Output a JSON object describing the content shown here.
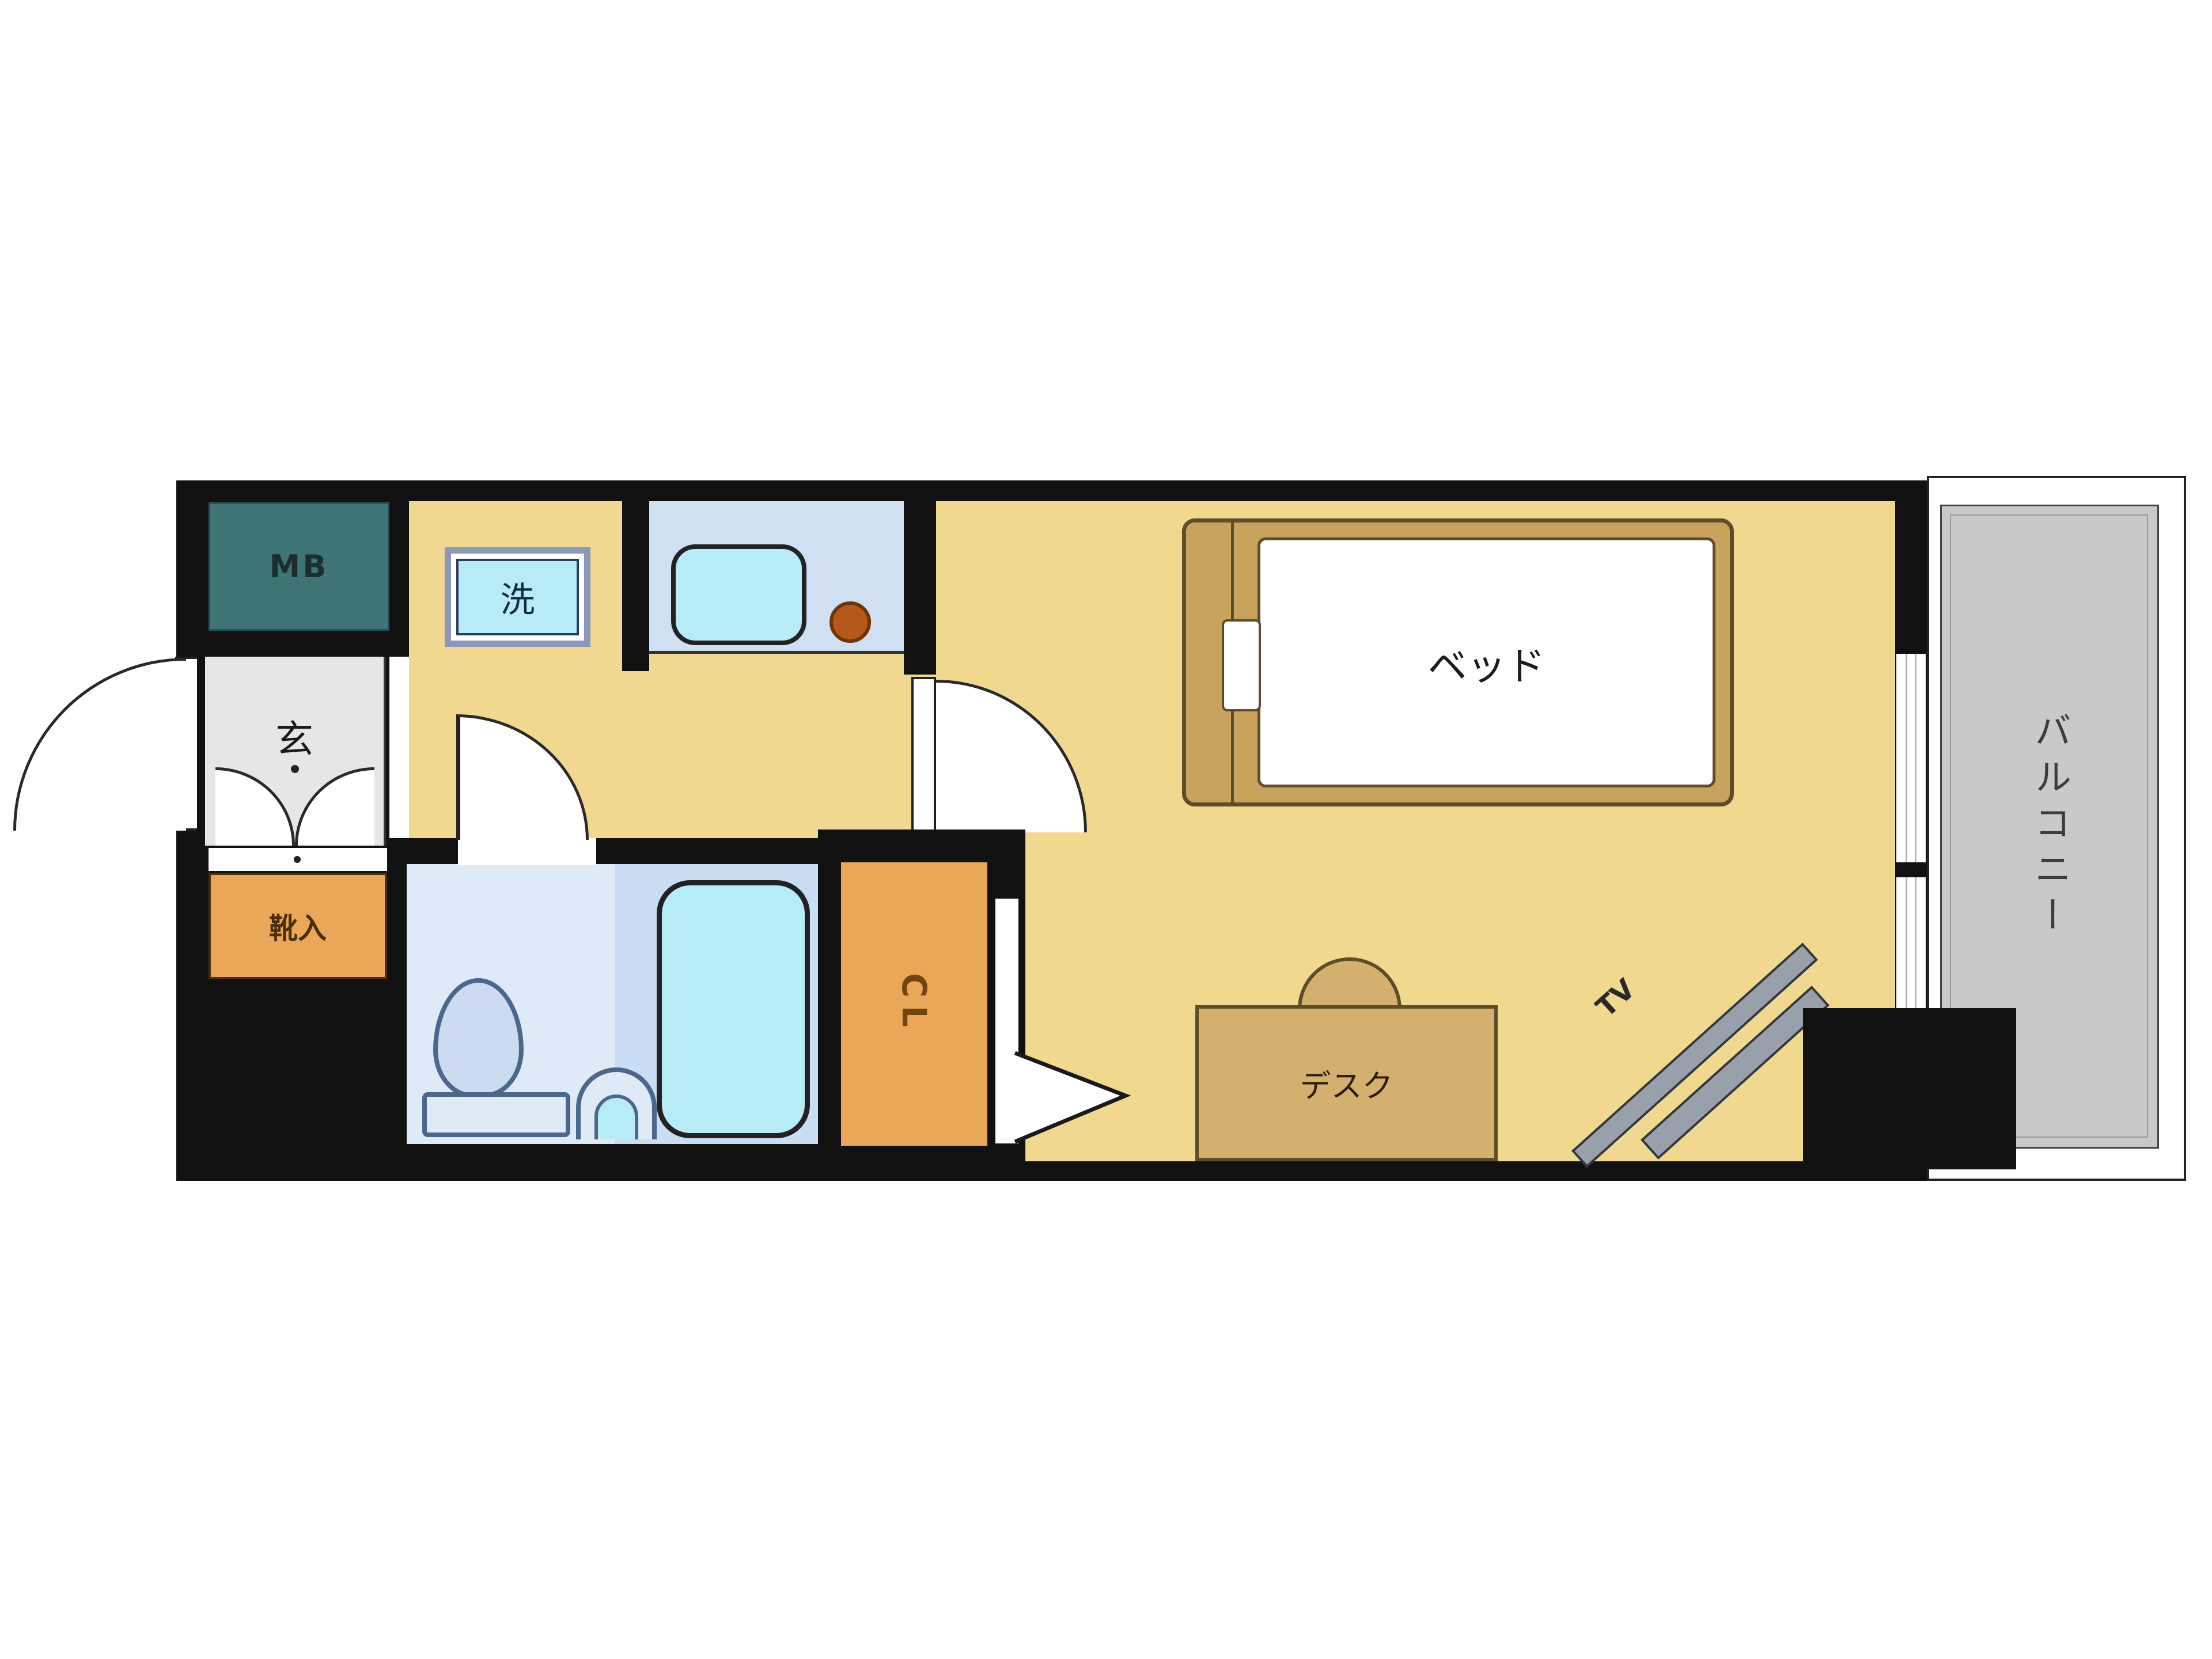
{
  "floorplan": {
    "labels": {
      "meter_box": "MB",
      "entrance": "玄",
      "shoe_cabinet": "靴入",
      "washing_machine": "洗",
      "closet": "CL",
      "bed": "ベッド",
      "desk": "デスク",
      "tv": "TV",
      "balcony": "バルコニー"
    },
    "colors": {
      "wall": "#111111",
      "floor_yellow": "#f0d98e",
      "meter_box_teal": "#3f7476",
      "entrance_gray": "#e6e6e6",
      "storage_orange": "#eaa757",
      "kitchen_counter_blue": "#cfe0f2",
      "bathroom_blue_light": "#dfeaf7",
      "bathroom_blue": "#c9def2",
      "fixture_cyan": "#b7ecf4",
      "burner_brown": "#b4591a",
      "bed_tan": "#c9a25e",
      "desk_tan": "#d3b06e",
      "tv_gray": "#98a1ab",
      "balcony_gray": "#c9c9c9"
    }
  }
}
